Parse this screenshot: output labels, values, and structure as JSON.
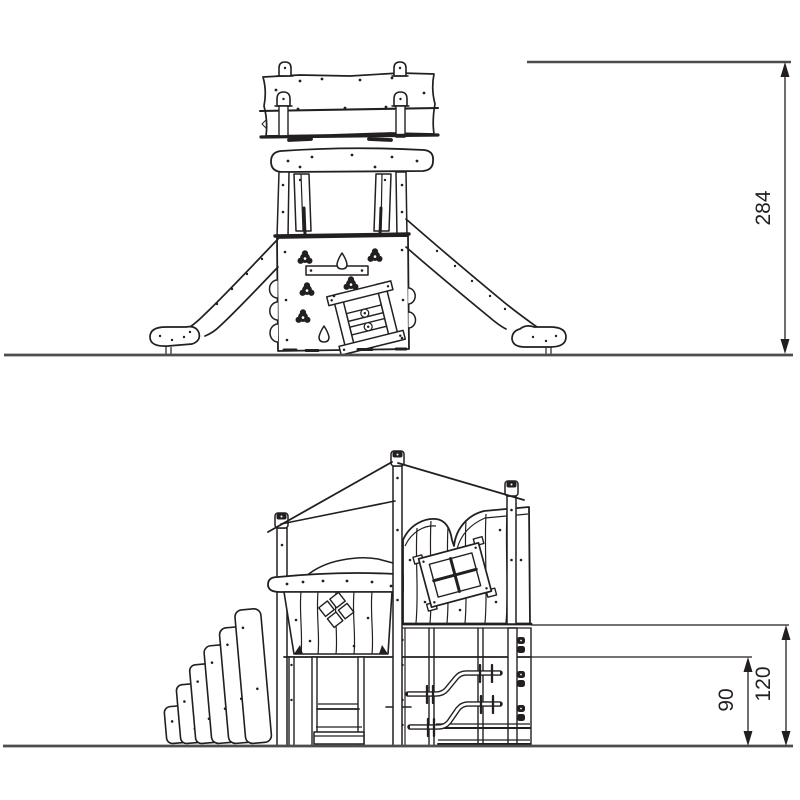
{
  "drawing": {
    "type": "playground-equipment-elevation-drawing",
    "views": [
      {
        "id": "front-elevation",
        "description": "front view: tower with banner top, climbing wall and two slides"
      },
      {
        "id": "side-elevation",
        "description": "side view: stair panels, clad playhouse with windows, handrail pipes"
      }
    ],
    "dimensions": {
      "front_height": "284",
      "side_deck_height": "120",
      "side_rail_height": "90"
    },
    "colors": {
      "line": "#231f20",
      "ground": "#4d4d4f",
      "background": "#ffffff"
    }
  }
}
